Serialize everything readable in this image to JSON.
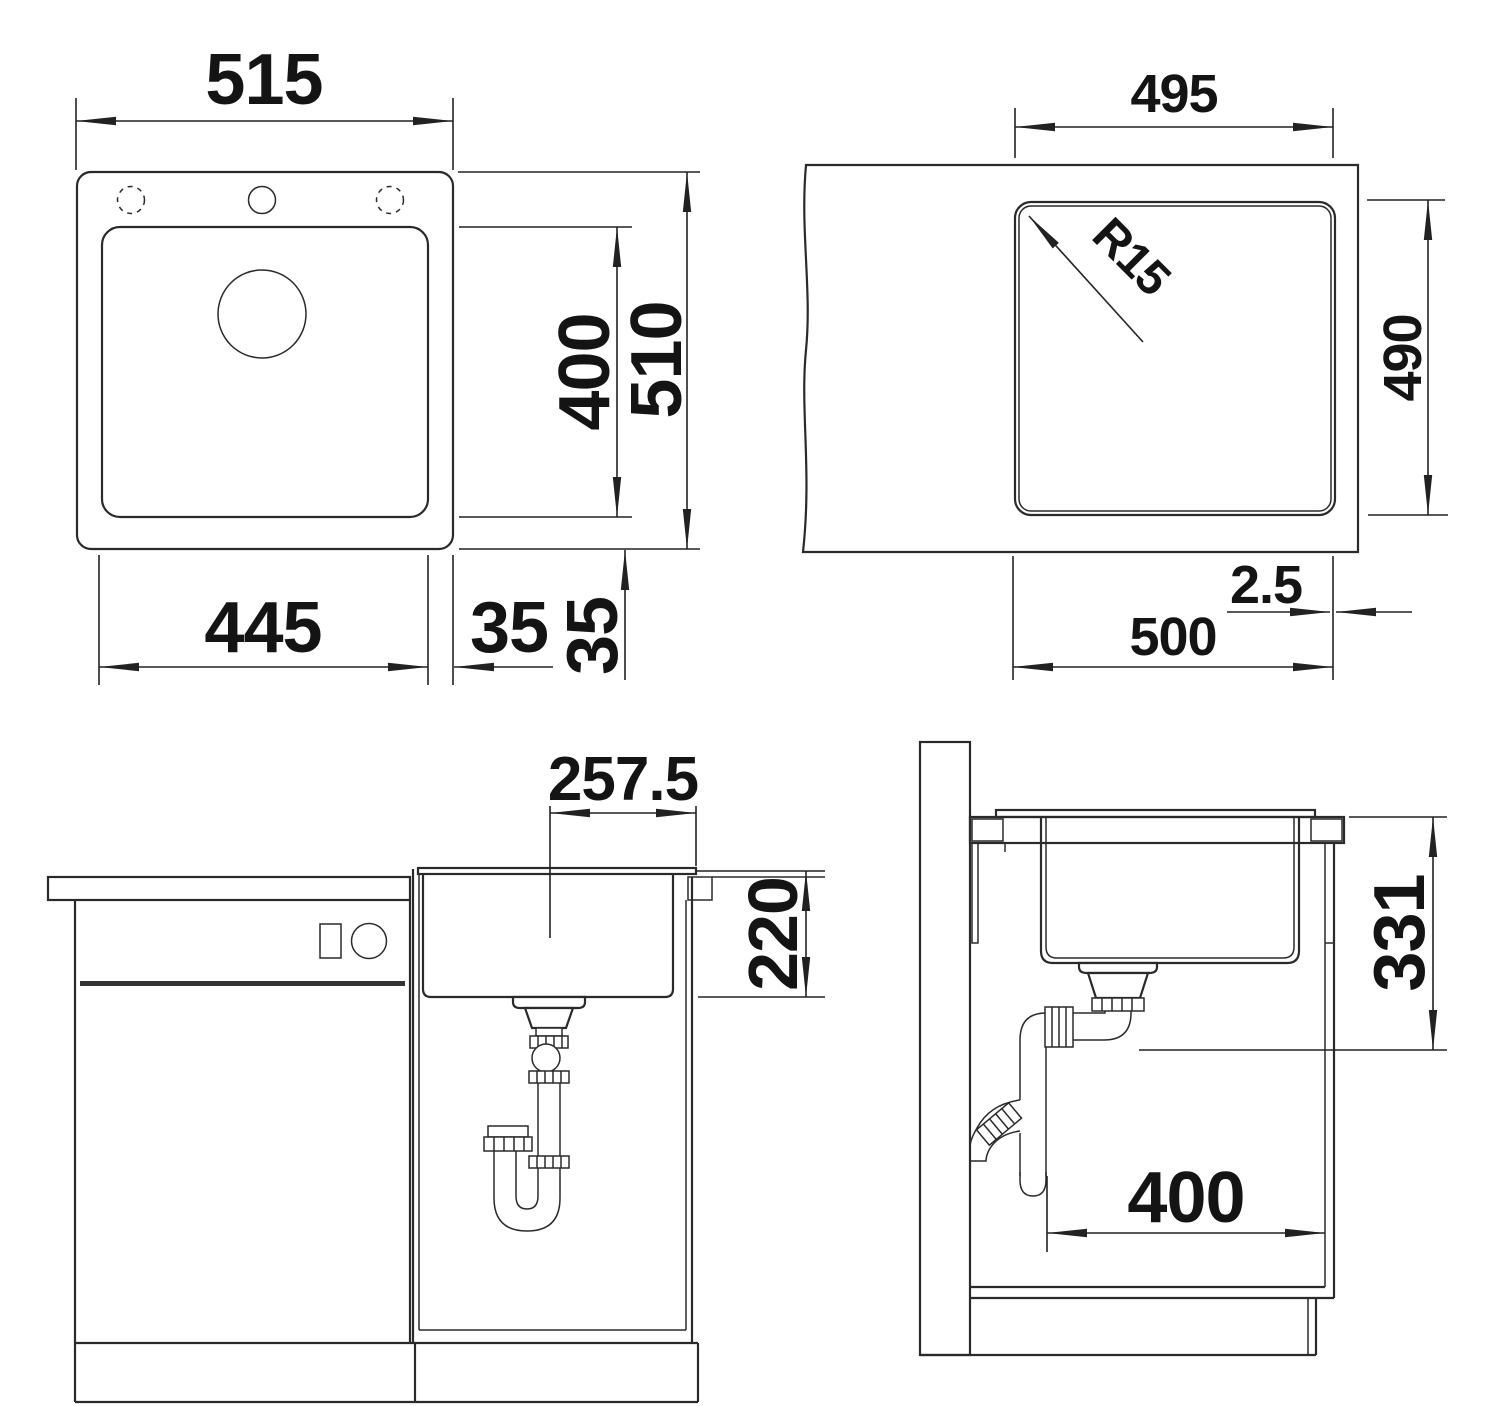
{
  "figures": {
    "top_view": {
      "labels": {
        "overall_width": "515",
        "overall_depth": "510",
        "bowl_depth": "400",
        "bowl_width": "445",
        "offset_right": "35",
        "offset_bottom": "35"
      }
    },
    "cutout_view": {
      "labels": {
        "cutout_width": "495",
        "corner_radius": "R15",
        "cutout_depth": "490",
        "edge_gap": "2.5",
        "cutout_width_total": "500"
      }
    },
    "front_view": {
      "labels": {
        "drain_center_offset": "257.5",
        "bowl_inner_depth": "220"
      }
    },
    "side_view": {
      "labels": {
        "worktop_to_outlet": "331",
        "trap_clearance": "400"
      }
    },
    "colors": {
      "line": "#2a2a2a",
      "text": "#141414",
      "background": "#ffffff"
    }
  }
}
